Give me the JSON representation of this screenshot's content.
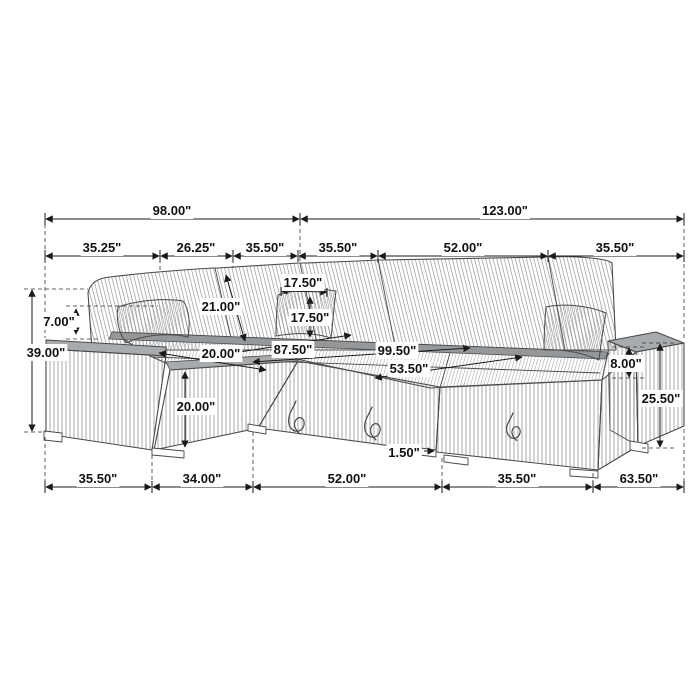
{
  "colors": {
    "outline": "#4a4a4a",
    "dimension_line": "#1a1a1a",
    "arm_top_fill": "#a7abad",
    "rear_ledge_fill": "#94989b",
    "background": "#ffffff"
  },
  "dimensions": {
    "top_total": {
      "left": "98.00\"",
      "right": "123.00\""
    },
    "top_segments": {
      "s1": "35.25\"",
      "s2": "26.25\"",
      "s3": "35.50\"",
      "s4": "35.50\"",
      "s5": "52.00\"",
      "s6": "35.50\""
    },
    "left_side": {
      "back_above_arm": "7.00\"",
      "overall_height": "39.00\""
    },
    "right_side": {
      "arm_above_seat": "8.00\"",
      "arm_height": "25.50\""
    },
    "interior": {
      "back_cushion_height": "21.00\"",
      "pillow_width": "17.50\"",
      "pillow_height": "17.50\"",
      "seat_depth": "20.00\"",
      "seat_height": "20.00\"",
      "bed_length": "87.50\"",
      "bed_diagonal": "99.50\"",
      "bed_width": "53.50\"",
      "leg_height": "1.50\""
    },
    "bottom_segments": {
      "s1": "35.50\"",
      "s2": "34.00\"",
      "s3": "52.00\"",
      "s4": "35.50\"",
      "s5": "63.50\""
    }
  }
}
